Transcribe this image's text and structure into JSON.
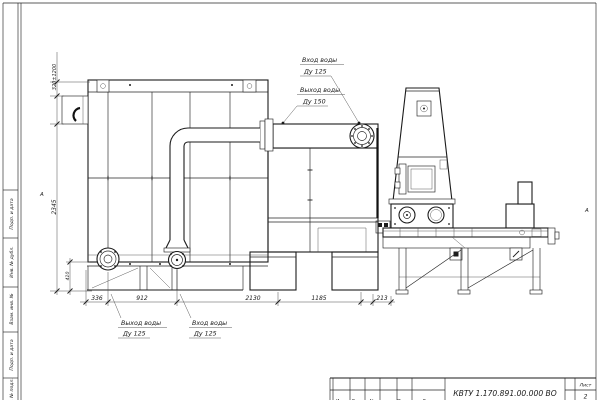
{
  "frame": {
    "stamps": [
      "Подп. и дата",
      "Инв. № дубл.",
      "Взам. инв. №",
      "Подп. и дата",
      "Инв. № подл."
    ],
    "view_marker_left": "А",
    "view_marker_right": "А"
  },
  "annotations": {
    "top_inlet": {
      "line1": "Вход воды",
      "line2": "Ду 125"
    },
    "top_outlet": {
      "line1": "Выход воды",
      "line2": "Ду 150"
    },
    "bottom_outlet": {
      "line1": "Выход воды",
      "line2": "Ду 125"
    },
    "bottom_inlet": {
      "line1": "Вход воды",
      "line2": "Ду 125"
    }
  },
  "dimensions": {
    "bracket_height": "320±1200",
    "overall_height": "2345",
    "base_height": "410",
    "bottom_chain": [
      "336",
      "912",
      "2130",
      "1185",
      "213"
    ]
  },
  "title_block": {
    "doc_number": "КВТУ 1.170.891.00.000 ВО",
    "sheet_label": "Лист",
    "sheet_value": "2",
    "revision_columns": [
      "Изм.",
      "Лист",
      "№ докум.",
      "Подп.",
      "Дата"
    ]
  },
  "colors": {
    "line": "#1b1b1b",
    "paper": "#ffffff"
  }
}
